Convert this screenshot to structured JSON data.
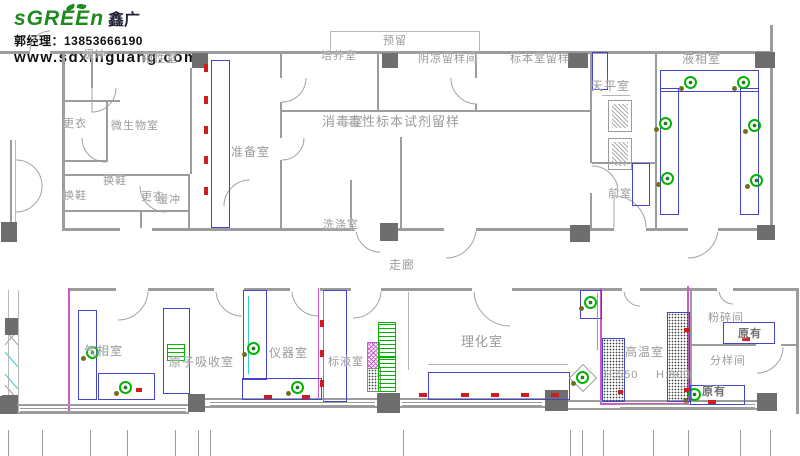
{
  "branding": {
    "logo_main": "sGREEn",
    "logo_cn": "鑫广",
    "contact": "郭经理：13853666190",
    "website": "www.sdxinguang.com"
  },
  "plan": {
    "labels": [
      {
        "text": "预留",
        "x": 383,
        "y": 36,
        "s": 11
      },
      {
        "text": "缓冲",
        "x": 83,
        "y": 50,
        "s": 11
      },
      {
        "text": "阳性室",
        "x": 142,
        "y": 54,
        "s": 11
      },
      {
        "text": "培养室",
        "x": 321,
        "y": 51,
        "s": 11
      },
      {
        "text": "阴凉留样间",
        "x": 418,
        "y": 54,
        "s": 11
      },
      {
        "text": "标本室留样",
        "x": 510,
        "y": 54,
        "s": 11
      },
      {
        "text": "液相室",
        "x": 682,
        "y": 53,
        "s": 12
      },
      {
        "text": "天平室",
        "x": 591,
        "y": 80,
        "s": 12
      },
      {
        "text": "更衣",
        "x": 63,
        "y": 119,
        "s": 11
      },
      {
        "text": "微生物室",
        "x": 111,
        "y": 121,
        "s": 11
      },
      {
        "text": "准备室",
        "x": 231,
        "y": 146,
        "s": 12
      },
      {
        "text": "消毒室",
        "x": 322,
        "y": 115,
        "s": 13
      },
      {
        "text": "毒性标本试剂留样",
        "x": 348,
        "y": 115,
        "s": 13
      },
      {
        "text": "换鞋",
        "x": 103,
        "y": 176,
        "s": 11
      },
      {
        "text": "换鞋",
        "x": 63,
        "y": 191,
        "s": 11
      },
      {
        "text": "更衣",
        "x": 141,
        "y": 192,
        "s": 11
      },
      {
        "text": "缓冲",
        "x": 157,
        "y": 195,
        "s": 11
      },
      {
        "text": "洗涤室",
        "x": 323,
        "y": 220,
        "s": 11
      },
      {
        "text": "前室",
        "x": 608,
        "y": 189,
        "s": 11
      },
      {
        "text": "走廊",
        "x": 389,
        "y": 259,
        "s": 12
      },
      {
        "text": "气相室",
        "x": 84,
        "y": 345,
        "s": 12
      },
      {
        "text": "原子吸收室",
        "x": 169,
        "y": 356,
        "s": 12
      },
      {
        "text": "仪器室",
        "x": 269,
        "y": 347,
        "s": 12
      },
      {
        "text": "标液室",
        "x": 328,
        "y": 357,
        "s": 11
      },
      {
        "text": "理化室",
        "x": 461,
        "y": 335,
        "s": 13
      },
      {
        "text": "高温室",
        "x": 625,
        "y": 346,
        "s": 12
      },
      {
        "text": "H:550",
        "x": 604,
        "y": 370,
        "s": 11
      },
      {
        "text": "H:800",
        "x": 656,
        "y": 370,
        "s": 11
      },
      {
        "text": "粉碎间",
        "x": 708,
        "y": 313,
        "s": 11
      },
      {
        "text": "原有",
        "x": 738,
        "y": 329,
        "s": 11,
        "dark": true
      },
      {
        "text": "分样间",
        "x": 710,
        "y": 356,
        "s": 11
      },
      {
        "text": "原有",
        "x": 702,
        "y": 387,
        "s": 11,
        "dark": true
      }
    ]
  },
  "colors": {
    "wall": "#9c9c9c",
    "wallLight": "#b8b8b8",
    "bench": "#4545c8",
    "magenta": "#cc58cc",
    "green": "#00b400",
    "greenDark": "#1f7a1f",
    "olive": "#6f6f1e",
    "red": "#cf1d1d",
    "cyan": "#2ecfcf",
    "column": "#6e6e6e",
    "text": "#9a9a9a",
    "brandGreen": "#1d8a1d"
  }
}
